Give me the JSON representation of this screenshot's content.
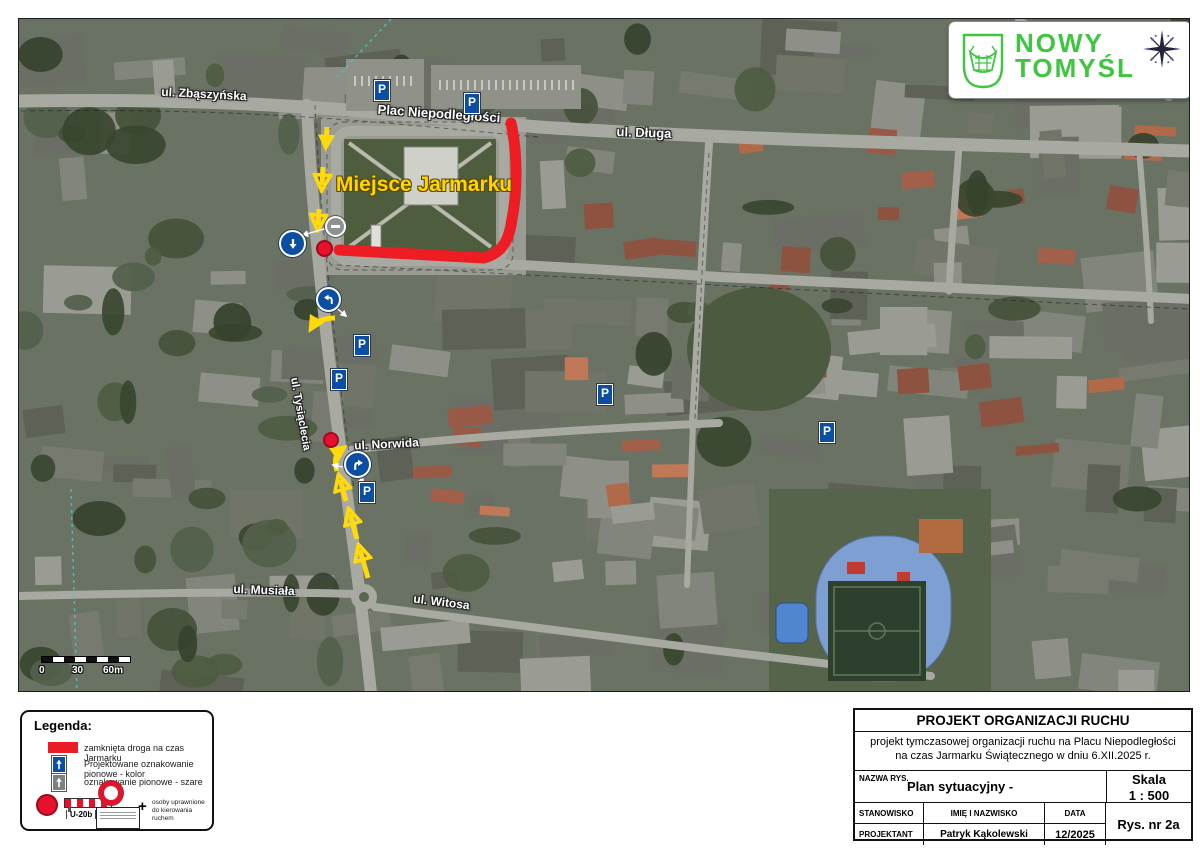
{
  "colors": {
    "closure_red": "#ec1c24",
    "sign_blue": "#0b4ea2",
    "arrow_yellow": "#ffd90a",
    "logo_green": "#3ec63e"
  },
  "logo": {
    "line1": "NOWY",
    "line2": "TOMYŚL"
  },
  "map": {
    "streets": {
      "zbaszynska": "ul. Zbąszyńska",
      "plac": "Plac Niepodległości",
      "dluga": "ul. Długa",
      "tysiaclecia": "ul. Tysiąclecia",
      "norwida": "ul. Norwida",
      "musiala": "ul. Musiała",
      "witosa": "ul. Witosa"
    },
    "market_label": "Miejsce Jarmarku",
    "parking_letter": "P",
    "scale_ticks": {
      "t0": "0",
      "t1": "30",
      "t2": "60m"
    }
  },
  "legend": {
    "title": "Legenda:",
    "item_closed_road": "zamknięta droga na czas Jarmarku",
    "item_signs_color": "Projektowane oznakowanie pionowe - kolor",
    "item_signs_gray": "oznakowanie pionowe - szare",
    "u20b": "U-20b",
    "plus": "+",
    "note_line1": "osoby uprawnione",
    "note_line2": "do kierowania ruchem"
  },
  "title_block": {
    "title": "PROJEKT ORGANIZACJI RUCHU",
    "subtitle_line1": "projekt tymczasowej organizacji ruchu na Placu Niepodległości",
    "subtitle_line2": "na czas Jarmarku Świątecznego w dniu 6.XII.2025 r.",
    "nazwa_rys_label": "NAZWA RYS.",
    "nazwa_rys_value": "Plan sytuacyjny -",
    "skala_label": "Skala",
    "skala_value": "1 : 500",
    "stanowisko_label": "STANOWISKO",
    "imie_label": "IMIĘ I NAZWISKO",
    "data_label": "DATA",
    "rys_nr": "Rys. nr 2a",
    "projektant_label": "PROJEKTANT",
    "projektant_name": "Patryk Kąkolewski",
    "data_value": "12/2025"
  }
}
